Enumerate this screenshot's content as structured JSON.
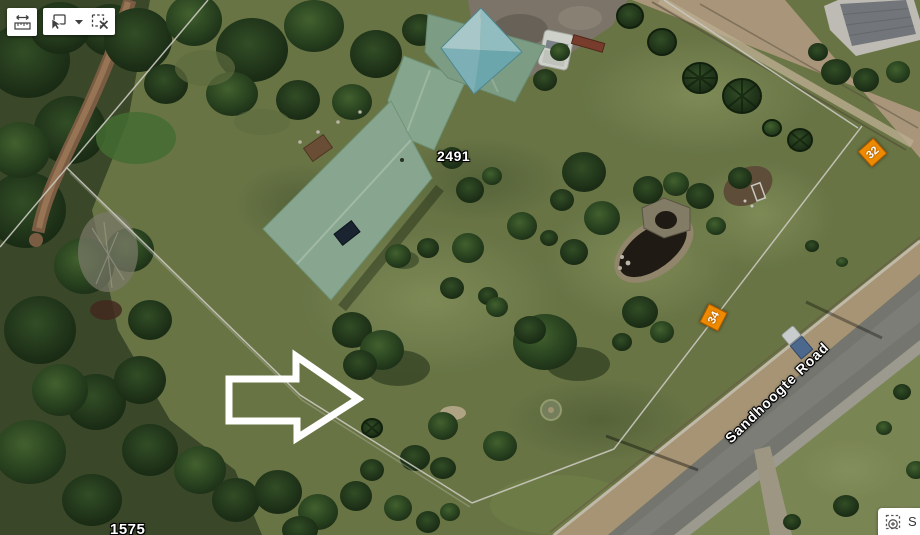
{
  "toolbar": {
    "buttons": [
      {
        "name": "measure",
        "icon": "measure-ruler-icon"
      },
      {
        "name": "select-by-rectangle",
        "icon": "select-rectangle-cursor-icon"
      },
      {
        "name": "select-options",
        "icon": "chevron-down-icon"
      },
      {
        "name": "clear-selection",
        "icon": "clear-selection-icon"
      }
    ]
  },
  "map": {
    "labels": {
      "parcel_number_main": "2491",
      "parcel_number_bottom": "1575",
      "road_name": "Sandhoogte Road",
      "distance_marker_a": "32",
      "distance_marker_b": "34"
    },
    "colors": {
      "distance_marker": "#EE8A00",
      "label_text": "#FFFFFF",
      "annotation_arrow": "#FFFFFF",
      "roof_green": "#9DC0A5",
      "gazebo_teal": "#8FCDD4",
      "road_asphalt": "#878780"
    },
    "annotations": {
      "arrow_direction": "right"
    }
  },
  "selection_panel": {
    "partial_text": "S",
    "icon": "zoom-to-selection-icon"
  }
}
